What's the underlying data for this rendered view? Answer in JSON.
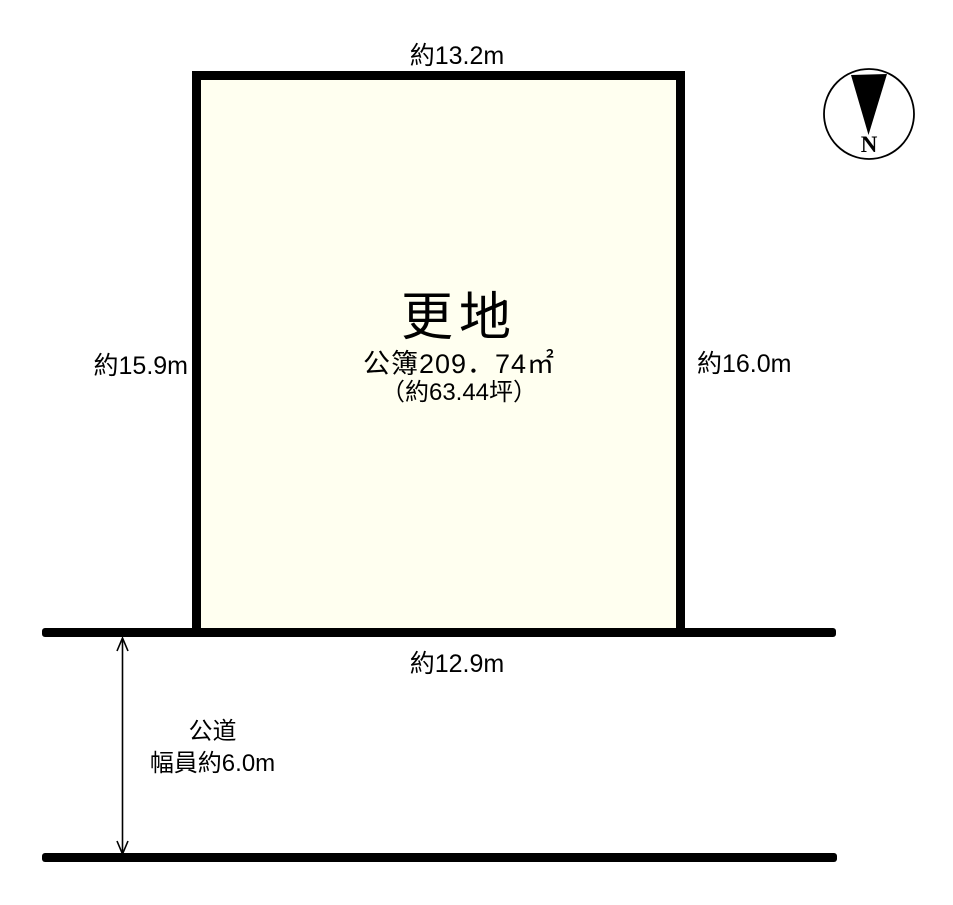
{
  "plot": {
    "title": "更地",
    "area_registered": "公簿209．74㎡",
    "area_tsubo": "（約63.44坪）",
    "dim_top": "約13.2m",
    "dim_left": "約15.9m",
    "dim_right": "約16.0m",
    "dim_bottom": "約12.9m",
    "fill_color": "#FFFFF0",
    "line_color": "#000000"
  },
  "road": {
    "name": "公道",
    "width_label": "幅員約6.0m"
  },
  "compass": {
    "north_label": "N"
  }
}
